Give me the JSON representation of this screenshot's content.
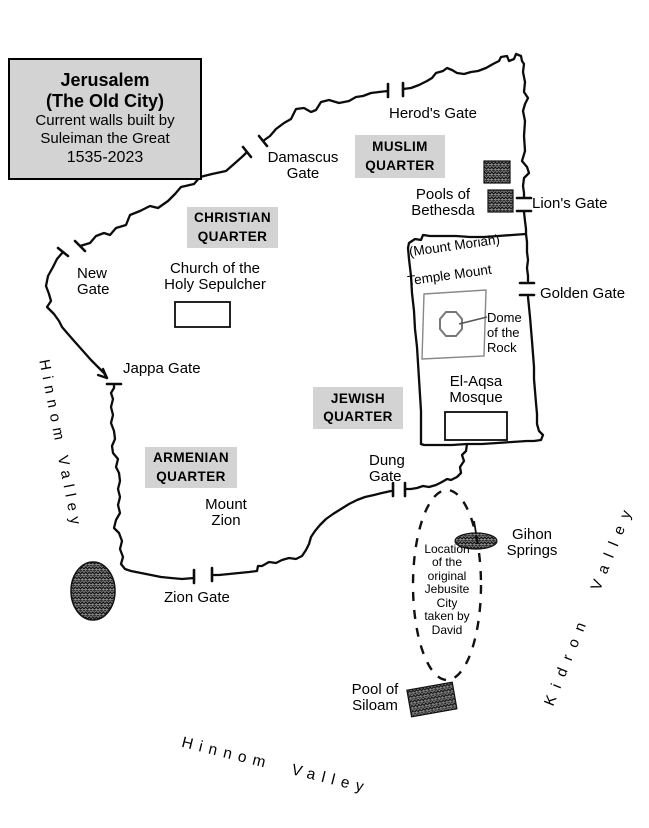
{
  "colors": {
    "panel_gray": "#d3d3d3",
    "ink": "#000000",
    "pool_fill": "#8a8a8a"
  },
  "legend": {
    "title1": "Jerusalem",
    "title2": "(The Old City)",
    "sub1": "Current walls built by",
    "sub2": "Suleiman the Great",
    "years": "1535-2023"
  },
  "quarters": {
    "muslim": "MUSLIM\nQUARTER",
    "christian": "CHRISTIAN\nQUARTER",
    "jewish": "JEWISH\nQUARTER",
    "armenian": "ARMENIAN\nQUARTER"
  },
  "gates": {
    "herods": "Herod's Gate",
    "damascus": "Damascus\nGate",
    "lions": "Lion's Gate",
    "golden": "Golden Gate",
    "new": "New\nGate",
    "jappa": "Jappa Gate",
    "dung": "Dung\nGate",
    "zion": "Zion Gate"
  },
  "landmarks": {
    "pools_bethesda": "Pools of\nBethesda",
    "church": "Church of the\nHoly Sepulcher",
    "mount_moriah": "(Mount Moriah)",
    "temple_mount": "Temple Mount",
    "dome": "Dome\nof the\nRock",
    "el_aqsa": "El-Aqsa\nMosque",
    "mount_zion": "Mount\nZion",
    "gihon": "Gihon\nSprings",
    "jebusite": "Location\nof the\noriginal\nJebusite\nCity\ntaken by\nDavid",
    "siloam": "Pool of\nSiloam"
  },
  "valleys": {
    "hinnom_left": "Hinnom Valley",
    "kidron": "Kidron Valley",
    "hinnom_bottom": "Hinnom Valley"
  }
}
